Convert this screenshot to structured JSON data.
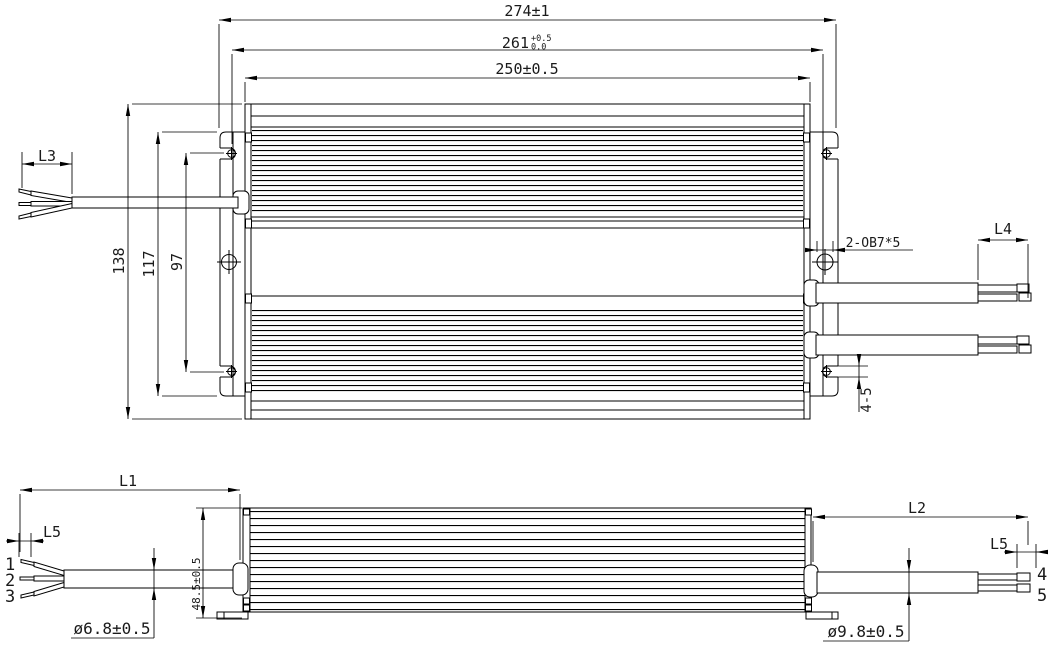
{
  "drawing": {
    "background": "#ffffff",
    "line_color": "#000000",
    "top_view": {
      "dim_overall_length": "274±1",
      "dim_mount_span_value": "261",
      "dim_mount_span_tol_upper": "+0.5",
      "dim_mount_span_tol_lower": "0.0",
      "dim_body_length": "250±0.5",
      "dim_overall_width": "138",
      "dim_bracket_width": "117",
      "dim_slot_spacing": "97",
      "dim_input_wire_strip": "L3",
      "dim_output_wire_strip": "L4",
      "dim_mount_slot": "2-OB7*5",
      "dim_cable_to_slot": "4-5"
    },
    "side_view": {
      "dim_input_cable_length": "L1",
      "dim_output_cable_length": "L2",
      "dim_input_tip_length": "L5",
      "dim_output_tip_length": "L5",
      "dim_input_cable_diameter": "ø6.8±0.5",
      "dim_output_cable_diameter": "ø9.8±0.5",
      "dim_body_height": "48.5±0.5",
      "input_wire_numbers": [
        "1",
        "2",
        "3"
      ],
      "output_wire_numbers": [
        "4",
        "5"
      ]
    }
  }
}
